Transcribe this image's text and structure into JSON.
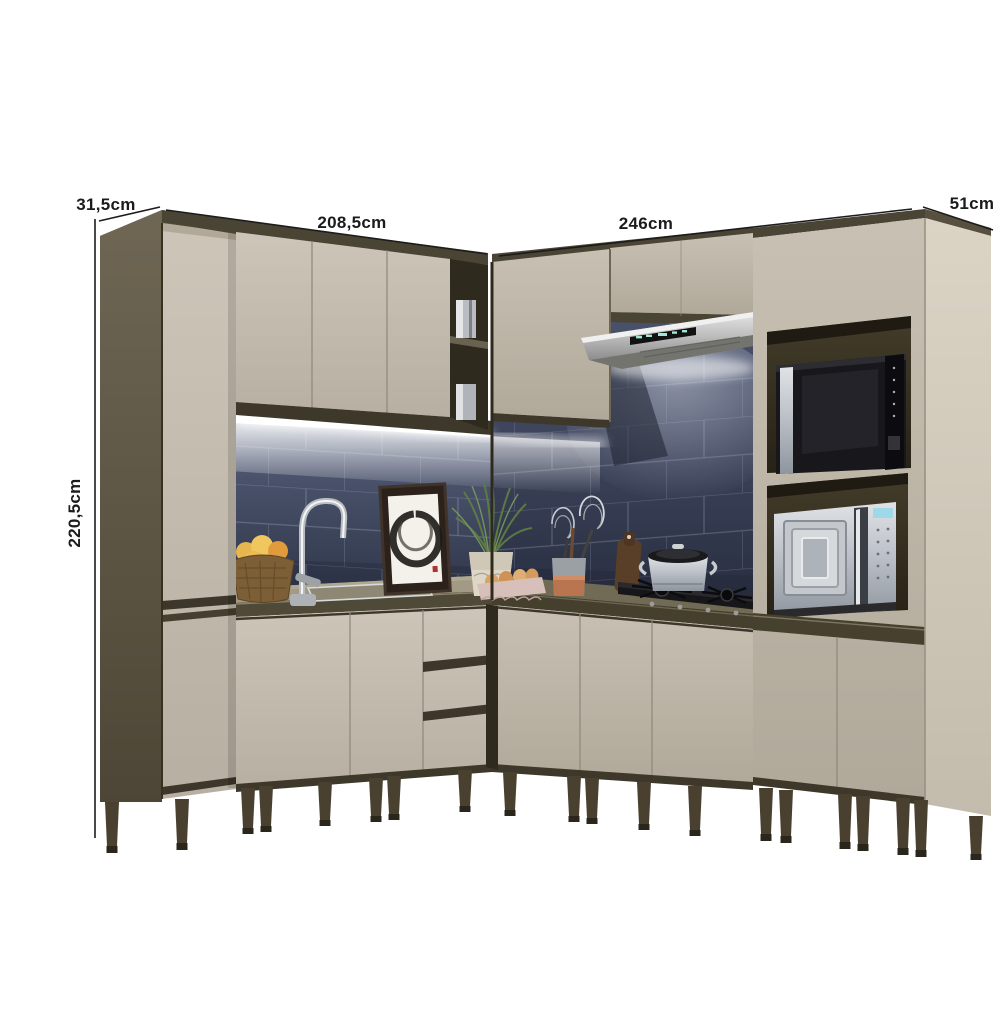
{
  "product_diagram": {
    "type": "modular-corner-kitchen-render",
    "background": "#ffffff",
    "measurements": {
      "left_depth": "31,5cm",
      "left_width": "208,5cm",
      "right_width": "246cm",
      "right_depth": "51cm",
      "height": "220,5cm"
    },
    "palette": {
      "cabinet_cream": "#c7bfb2",
      "cabinet_dark_wood": "#4a4434",
      "countertop_olive": "#847d67",
      "backsplash_navy_tile": "#414a61",
      "grout": "#8f98b0",
      "leg_brown": "#493f2e",
      "stainless": "#c9c9c9",
      "annotation_text": "#1b1b1b"
    }
  }
}
